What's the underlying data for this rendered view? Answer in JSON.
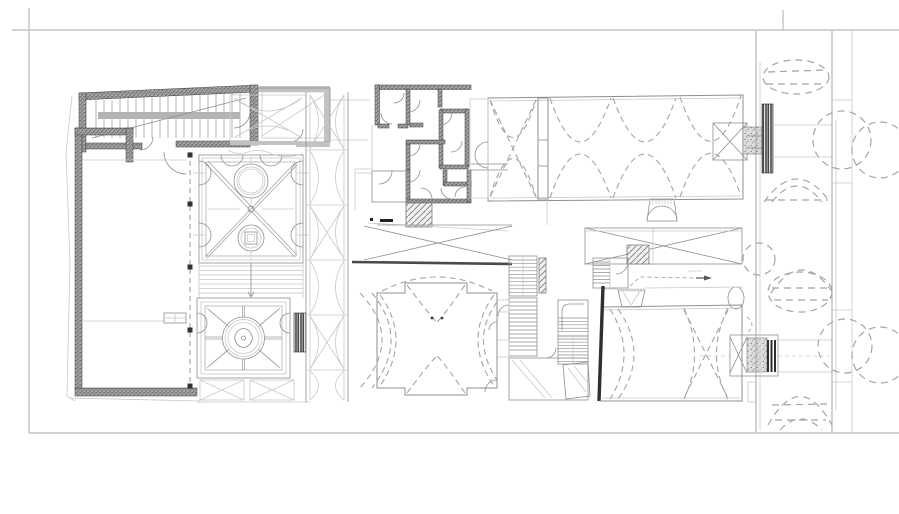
{
  "sheet": {
    "kind": "architectural floor plan drawing",
    "background": "#ffffff",
    "border_color": "#c4c4c4"
  },
  "palette": {
    "bg": "#ffffff",
    "ink": "#3e3e3e",
    "line": "#8f8f8f",
    "faint": "#c9c9c9",
    "light": "#c4c4c4",
    "dash": "#a5a5a5",
    "rail": "#b4b4b4",
    "black": "#222222",
    "heavy": "#2b2b2b"
  },
  "plan": {
    "elements": [
      "sheet-border",
      "northwest-stair-block",
      "left-wing-room",
      "upper-parterre-garden",
      "garden-steps",
      "lower-parterre-garden",
      "garden-fence-panels",
      "west-gallery-bays",
      "service-rooms-cluster",
      "north-great-hall",
      "northeast-portal",
      "courtyard-strip",
      "south-stair-cluster",
      "south-cross-hall",
      "southeast-vaulted-hall",
      "southeast-portal",
      "east-road",
      "tree-canopies-northeast",
      "tree-canopies-southeast"
    ]
  }
}
